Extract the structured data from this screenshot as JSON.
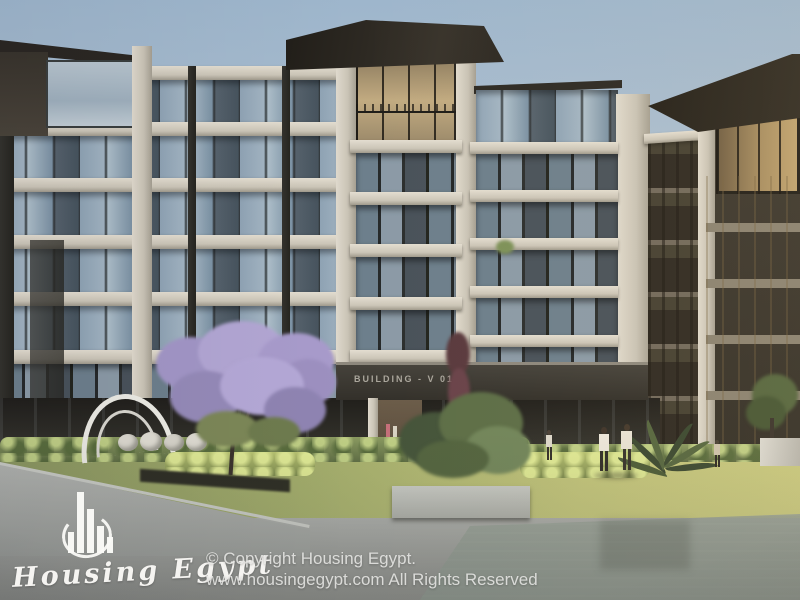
{
  "scene": {
    "type": "architectural-exterior-render",
    "building_sign": "BUILDING - V 01",
    "elements": [
      "residential building facade",
      "central tower",
      "right wing",
      "neighbor building",
      "jacaranda tree",
      "hedgerow",
      "lawn",
      "plaza pavement",
      "reflecting pool",
      "arch sculpture",
      "pedestrians",
      "potted tree"
    ],
    "palette": {
      "sky_top": "#9eb6cc",
      "sky_horizon": "#ccd2d7",
      "concrete_light": "#d8d2c5",
      "glass_blue": "#8fa3b4",
      "glass_dark": "#47545e",
      "roof_dark": "#28241c",
      "facade_dark": "#2e2d28",
      "right_building": "#3e3930",
      "hedge_green": "#6f7f4f",
      "grass_sunlit": "#c0c37a",
      "grass_shaded": "#8a9660",
      "pavement_gray": "#9b9d99",
      "jacaranda_purple": "#ab9ecb",
      "watermark_white": "#f5f4f1"
    }
  },
  "watermark": {
    "brand": "Housing Egypt",
    "logo": "bar-chart-buildings-in-circle",
    "copyright_line1": "© Copyright Housing Egypt.",
    "copyright_line2": "www.housingegypt.com All Rights Reserved"
  }
}
